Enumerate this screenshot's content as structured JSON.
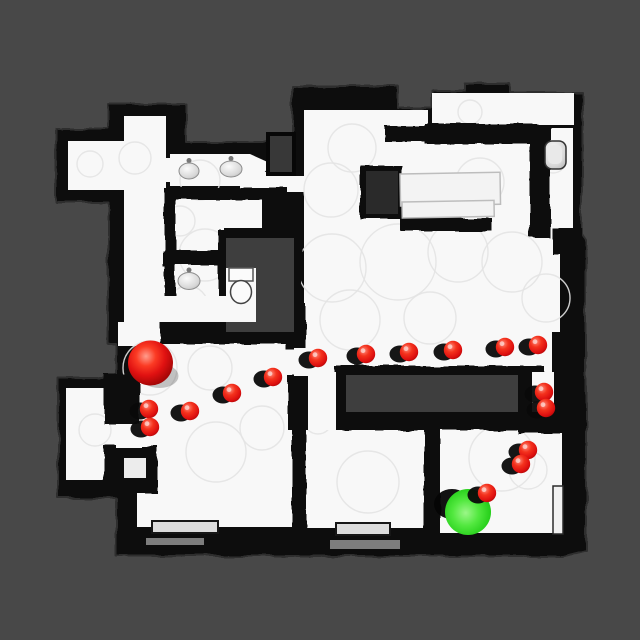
{
  "scene": {
    "description": "top-down 3D scanned apartment floor map with navigation path",
    "colors": {
      "background": "#484848",
      "floor": "#f8f8f8",
      "wall": "#070707",
      "hole": "#3e3e3e",
      "closet_hole": "#2a2a2a",
      "red_sphere": "#e01111",
      "green_sphere": "#2fce1e",
      "scan_circle_stroke": "#e3e3e3"
    },
    "markers": {
      "start": {
        "x": 150.5,
        "y": 363,
        "r": 22.5
      },
      "goal": {
        "x": 468,
        "y": 512,
        "r": 23
      },
      "waypoint_radius": 9.2,
      "waypoints": [
        [
          149,
          409
        ],
        [
          150,
          427
        ],
        [
          190,
          411
        ],
        [
          232,
          393
        ],
        [
          273,
          377
        ],
        [
          318,
          358
        ],
        [
          366,
          354
        ],
        [
          409,
          352
        ],
        [
          453,
          350
        ],
        [
          505,
          347
        ],
        [
          538,
          345
        ],
        [
          544,
          392
        ],
        [
          546,
          408
        ],
        [
          528,
          450
        ],
        [
          521,
          464
        ],
        [
          487,
          493
        ]
      ],
      "shadow": {
        "dx": -9,
        "dy": 2,
        "rx": 10.5,
        "ry": 8.5
      },
      "goal_shadow": {
        "dx": -16,
        "dy": -8,
        "rx": 18,
        "ry": 15
      },
      "last_waypoint_drawn_over_goal": true
    },
    "fixtures": {
      "sinks": [
        {
          "cx": 189,
          "cy": 171,
          "rx": 10,
          "ry": 8
        },
        {
          "cx": 231,
          "cy": 169,
          "rx": 11,
          "ry": 8
        },
        {
          "cx": 189,
          "cy": 281,
          "rx": 11,
          "ry": 8.5
        }
      ],
      "toilet": {
        "tank": {
          "x": 229,
          "y": 268,
          "w": 24,
          "h": 13
        },
        "bowl": {
          "cx": 241,
          "cy": 292,
          "rx": 10.5,
          "ry": 11.5
        }
      },
      "wall_basin": {
        "x": 545,
        "y": 141,
        "w": 21,
        "h": 28,
        "r": 7
      },
      "tables": [
        {
          "x": 400,
          "y": 174,
          "w": 100,
          "h": 32
        },
        {
          "x": 402,
          "y": 202,
          "w": 92,
          "h": 16
        }
      ],
      "door_leaf": {
        "x": 553,
        "y": 486,
        "w": 10,
        "h": 48
      },
      "thresholds": [
        {
          "x": 152,
          "y": 521,
          "w": 66,
          "h": 12
        },
        {
          "x": 336,
          "y": 523,
          "w": 54,
          "h": 12
        }
      ],
      "floor_streaks": [
        {
          "x": 146,
          "y": 538,
          "w": 58,
          "h": 7
        },
        {
          "x": 330,
          "y": 540,
          "w": 70,
          "h": 9
        }
      ]
    },
    "scan_circles": [
      [
        150,
        368,
        27
      ],
      [
        205,
        255,
        26
      ],
      [
        188,
        306,
        20
      ],
      [
        216,
        452,
        30
      ],
      [
        262,
        428,
        22
      ],
      [
        332,
        268,
        34
      ],
      [
        398,
        262,
        38
      ],
      [
        458,
        252,
        30
      ],
      [
        512,
        262,
        30
      ],
      [
        352,
        148,
        24
      ],
      [
        331,
        190,
        27
      ],
      [
        480,
        182,
        24
      ],
      [
        546,
        298,
        24
      ],
      [
        502,
        458,
        33
      ],
      [
        528,
        470,
        19
      ],
      [
        368,
        482,
        31
      ],
      [
        180,
        221,
        15
      ],
      [
        243,
        302,
        18
      ],
      [
        553,
        160,
        13
      ],
      [
        470,
        112,
        12
      ],
      [
        432,
        200,
        26
      ],
      [
        318,
        420,
        14
      ],
      [
        200,
        180,
        20
      ],
      [
        90,
        164,
        13
      ],
      [
        135,
        158,
        16
      ],
      [
        350,
        320,
        30
      ],
      [
        430,
        318,
        26
      ],
      [
        95,
        430,
        16
      ],
      [
        210,
        368,
        22
      ]
    ]
  }
}
